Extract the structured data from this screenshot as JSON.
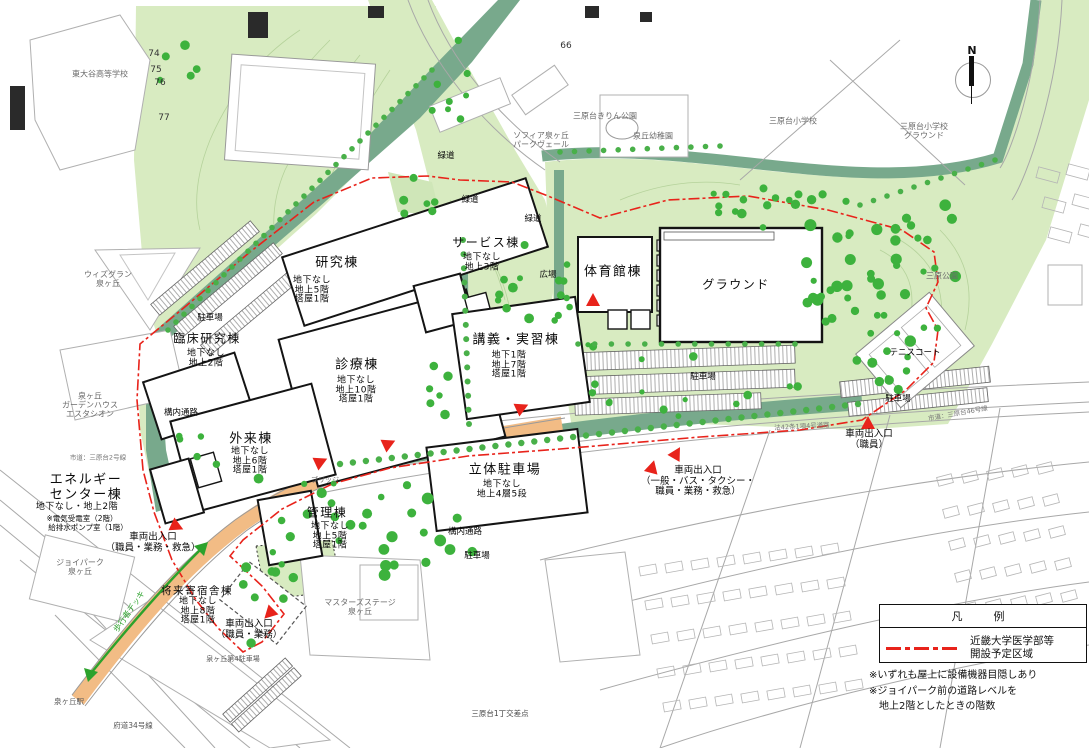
{
  "colors": {
    "park_green": "#d8ebc1",
    "corridor_green": "#78a98c",
    "tree_green": "#3db23d",
    "road_orange": "#f2bc85",
    "boundary_red": "#e8231b",
    "arrow_green": "#2ca22c"
  },
  "compass": {
    "label": "N"
  },
  "contour_numbers": [
    {
      "text": "74",
      "x": 154,
      "y": 54
    },
    {
      "text": "75",
      "x": 156,
      "y": 70
    },
    {
      "text": "76",
      "x": 160,
      "y": 83
    },
    {
      "text": "77",
      "x": 164,
      "y": 118
    },
    {
      "text": "66",
      "x": 566,
      "y": 46
    }
  ],
  "buildings": [
    {
      "key": "research",
      "name": "研究棟",
      "floors": [
        "地下なし",
        "地上5階",
        "塔屋1階"
      ],
      "nx": 337,
      "ny": 264,
      "fx": 312,
      "fy": 291,
      "ns": 13
    },
    {
      "key": "clinical-research",
      "name": "臨床研究棟",
      "floors": [
        "地下なし",
        "地上2階"
      ],
      "nx": 207,
      "ny": 339,
      "fx": 206,
      "fy": 359,
      "ns": 12
    },
    {
      "key": "clinic",
      "name": "診療棟",
      "floors": [
        "地下なし",
        "地上10階",
        "塔屋1階"
      ],
      "nx": 357,
      "ny": 366,
      "fx": 356,
      "fy": 391,
      "ns": 13
    },
    {
      "key": "outpatient",
      "name": "外来棟",
      "floors": [
        "地下なし",
        "地上6階",
        "塔屋1階"
      ],
      "nx": 251,
      "ny": 440,
      "fx": 250,
      "fy": 462,
      "ns": 13
    },
    {
      "key": "service",
      "name": "サービス棟",
      "floors": [
        "地下なし",
        "地上3階"
      ],
      "nx": 486,
      "ny": 243,
      "fx": 482,
      "fy": 263,
      "ns": 12
    },
    {
      "key": "lecture-training",
      "name": "講義・実習棟",
      "floors": [
        "地下1階",
        "地上7階",
        "塔屋1階"
      ],
      "nx": 516,
      "ny": 341,
      "fx": 509,
      "fy": 366,
      "ns": 13
    },
    {
      "key": "gymnasium",
      "name": "体育館棟",
      "floors": [],
      "nx": 613,
      "ny": 273,
      "fx": 613,
      "fy": 290,
      "ns": 13
    },
    {
      "key": "ground",
      "name": "グラウンド",
      "floors": [],
      "nx": 736,
      "ny": 285,
      "fx": 736,
      "fy": 300,
      "ns": 12
    },
    {
      "key": "parking-structure",
      "name": "立体駐車場",
      "floors": [
        "地下なし",
        "地上4層5段"
      ],
      "nx": 505,
      "ny": 471,
      "fx": 502,
      "fy": 490,
      "ns": 13
    },
    {
      "key": "administration",
      "name": "管理棟",
      "floors": [
        "地下なし",
        "地上5階",
        "塔屋1階"
      ],
      "nx": 327,
      "ny": 513,
      "fx": 330,
      "fy": 537,
      "ns": 12
    },
    {
      "key": "energy-center",
      "name": "エネルギー\nセンター棟",
      "floors": [
        "地下なし・地上2階"
      ],
      "nx": 86,
      "ny": 488,
      "fx": 77,
      "fy": 508,
      "ns": 13
    },
    {
      "key": "future-dormitory",
      "name": "将来寄宿舎棟",
      "floors": [
        "地下なし",
        "地上8階",
        "塔屋1階"
      ],
      "nx": 197,
      "ny": 592,
      "fx": 198,
      "fy": 612,
      "ns": 10.5
    }
  ],
  "entrances": [
    {
      "lines": [
        "車両出入口",
        "（職員・業務・救急）"
      ],
      "x": 153,
      "y": 543
    },
    {
      "lines": [
        "車両出入口",
        "（職員・業務）"
      ],
      "x": 249,
      "y": 630
    },
    {
      "lines": [
        "車両出入口",
        "（一般・バス・タクシー・",
        "職員・業務・救急）"
      ],
      "x": 698,
      "y": 482
    },
    {
      "lines": [
        "車両出入口",
        "（職員）"
      ],
      "x": 869,
      "y": 440
    }
  ],
  "site_labels": [
    {
      "text": "緑道",
      "x": 446,
      "y": 157
    },
    {
      "text": "緑道",
      "x": 470,
      "y": 201
    },
    {
      "text": "緑道",
      "x": 533,
      "y": 220
    },
    {
      "text": "広場",
      "x": 548,
      "y": 276
    },
    {
      "text": "駐車場",
      "x": 210,
      "y": 319
    },
    {
      "text": "駐車場",
      "x": 703,
      "y": 378
    },
    {
      "text": "駐車場",
      "x": 477,
      "y": 557
    },
    {
      "text": "駐車場",
      "x": 898,
      "y": 400
    },
    {
      "text": "構内通路",
      "x": 181,
      "y": 414
    },
    {
      "text": "構内通路",
      "x": 465,
      "y": 533
    },
    {
      "text": "テニスコート",
      "x": 915,
      "y": 354
    },
    {
      "text": "ブリッジ",
      "x": 325,
      "y": 481,
      "size": 7,
      "color": "#666"
    },
    {
      "text": "歩行者デッキ",
      "x": 130,
      "y": 612,
      "rot": -55,
      "size": 8,
      "color": "#2ca22c"
    },
    {
      "text": "泉ヶ丘第4駐車場",
      "x": 233,
      "y": 660,
      "size": 7,
      "color": "#555"
    },
    {
      "text": "三原台1丁交差点",
      "x": 500,
      "y": 714,
      "size": 7.5,
      "color": "#444"
    },
    {
      "text": "泉ヶ丘駅",
      "x": 69,
      "y": 702,
      "size": 7.5,
      "color": "#555"
    },
    {
      "text": "府道34号線",
      "x": 133,
      "y": 726,
      "size": 7.5,
      "color": "#555"
    },
    {
      "text": "市道：三原台2号線",
      "x": 98,
      "y": 458,
      "size": 6.5,
      "color": "#777"
    },
    {
      "text": "法42条1項4号道路",
      "x": 802,
      "y": 427,
      "size": 6.5,
      "color": "#777",
      "rot": -3
    },
    {
      "text": "市道：三原台46号線",
      "x": 958,
      "y": 414,
      "size": 6.5,
      "color": "#777",
      "rot": -10
    },
    {
      "text": "※電気受電室（2階）",
      "x": 82,
      "y": 519,
      "size": 7.5
    },
    {
      "text": "給排水ポンプ室（1階）",
      "x": 88,
      "y": 528,
      "size": 7.5
    }
  ],
  "surrounding_labels": [
    {
      "lines": [
        "東大谷高等学校"
      ],
      "x": 100,
      "y": 75
    },
    {
      "lines": [
        "ウィズグラン",
        "泉ヶ丘"
      ],
      "x": 108,
      "y": 280
    },
    {
      "lines": [
        "泉ヶ丘",
        "ガーデンハウス",
        "エスタシオン"
      ],
      "x": 90,
      "y": 406
    },
    {
      "lines": [
        "ジョイパーク",
        "泉ヶ丘"
      ],
      "x": 80,
      "y": 568
    },
    {
      "lines": [
        "マスターズステージ",
        "泉ヶ丘"
      ],
      "x": 360,
      "y": 608
    },
    {
      "lines": [
        "ソフィア泉ヶ丘",
        "パークヴェール"
      ],
      "x": 541,
      "y": 141
    },
    {
      "lines": [
        "三原台きりん公園"
      ],
      "x": 605,
      "y": 117
    },
    {
      "lines": [
        "泉丘幼稚園"
      ],
      "x": 653,
      "y": 137
    },
    {
      "lines": [
        "三原台小学校"
      ],
      "x": 793,
      "y": 122
    },
    {
      "lines": [
        "三原台小学校",
        "グラウンド"
      ],
      "x": 924,
      "y": 132
    },
    {
      "lines": [
        "三原公園"
      ],
      "x": 942,
      "y": 277
    }
  ],
  "legend": {
    "title": "凡　例",
    "item_lines": [
      "近畿大学医学部等",
      "開設予定区域"
    ]
  },
  "notes": [
    "※いずれも屋上に設備機器目隠しあり",
    "※ジョイパーク前の道路レベルを",
    "　地上2階としたときの階数"
  ]
}
